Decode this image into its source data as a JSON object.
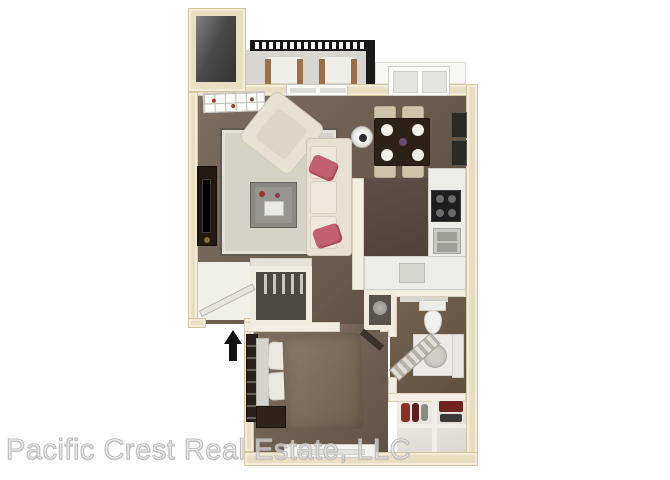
{
  "watermark": {
    "text": "Pacific Crest Real Estate, LLC"
  },
  "floor_plan": {
    "type": "3d-rendered-apartment-floor-plan",
    "rooms": [
      "storage-closet",
      "balcony",
      "living-room",
      "dining-area",
      "kitchen",
      "entry",
      "coat-closet",
      "hallway",
      "water-heater-closet",
      "bedroom",
      "bathroom",
      "walk-in-closet"
    ],
    "entry_indicator": "up-arrow"
  },
  "colors": {
    "wall_beige": "#e8dfc2",
    "wall_beige_edge": "#d3c6a0",
    "carpet_brown": "#6e6051",
    "kitchen_floor": "#4e4238",
    "balcony_floor": "#d7d6d2",
    "sofa_cream": "#e7e1d2",
    "accent_pink": "#c2616d",
    "wood_dark": "#2c2116",
    "railing_black": "#1b1b1b",
    "watermark_gray": "#bdbdbd"
  }
}
